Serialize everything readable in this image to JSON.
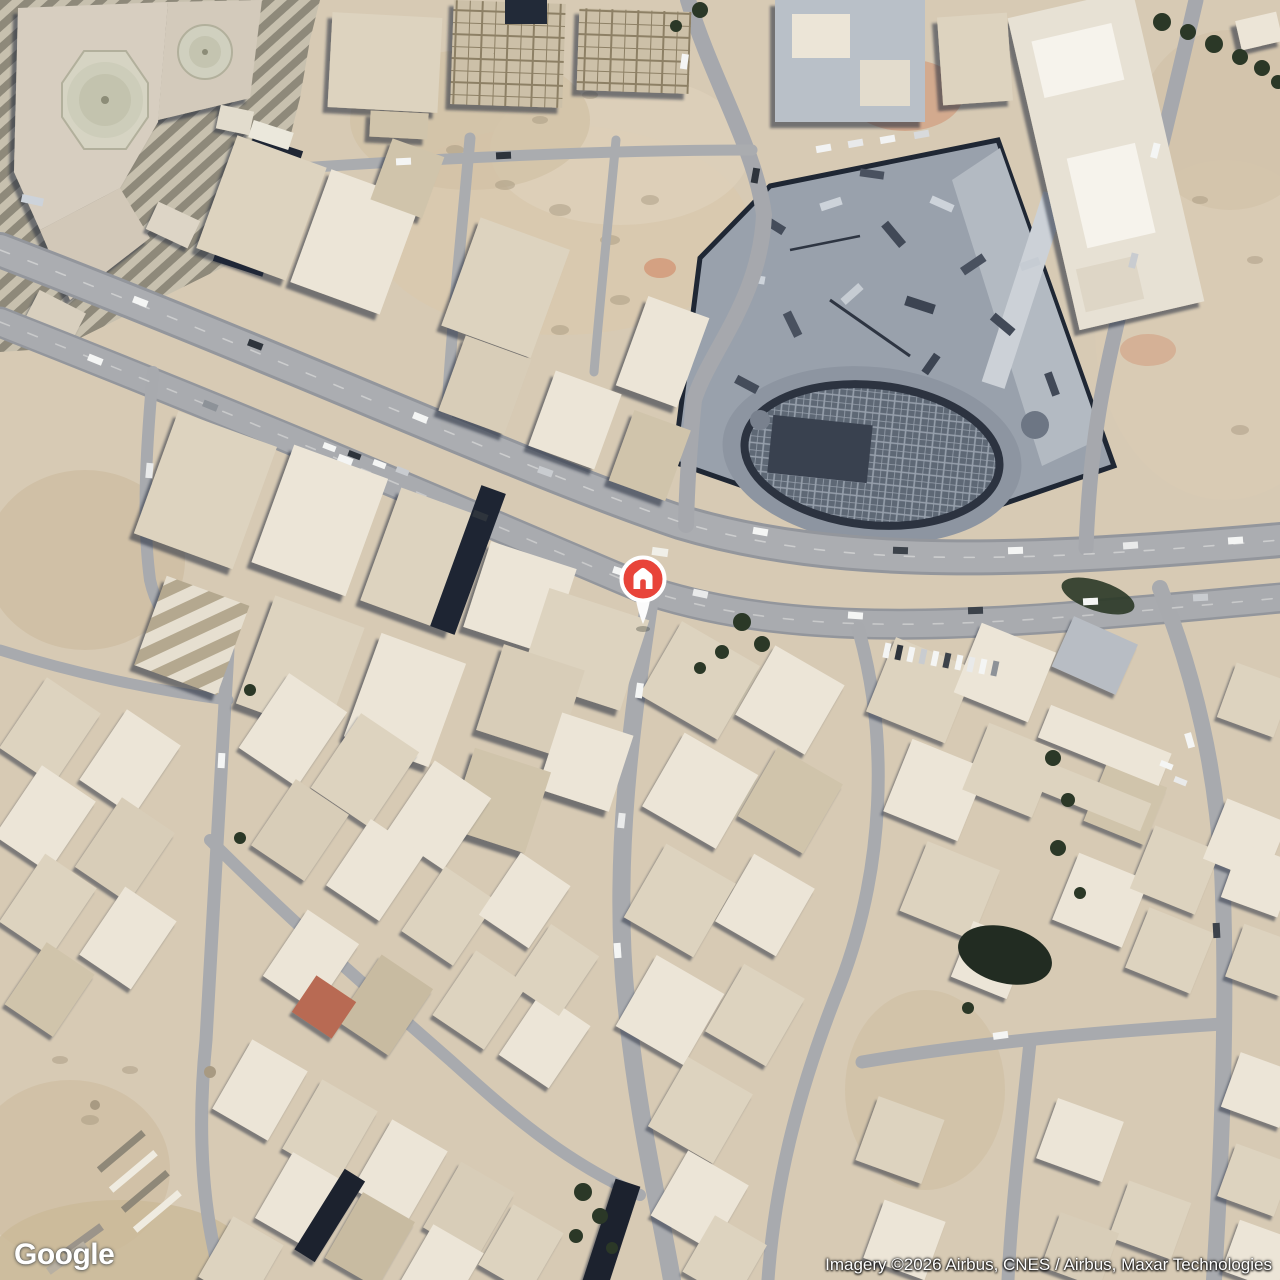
{
  "map": {
    "view_type": "satellite",
    "provider": "Google",
    "marker": {
      "type": "place-marker",
      "glyph": "home",
      "pin_color": "#E8443A",
      "glyph_color": "#FFFFFF",
      "border_color": "#FFFFFF"
    }
  },
  "watermark": {
    "logo_text": "Google"
  },
  "attribution": {
    "text": "Imagery ©2026 Airbus, CNES / Airbus, Maxar Technologies"
  },
  "palette": {
    "sand": "#d7cab4",
    "sand_dark": "#c8b598",
    "road": "#a9abb0",
    "building_light": "#ece5d7",
    "building_mid": "#ddd3bf",
    "building_tan": "#d0c4ab",
    "shadow_navy": "#1f2634",
    "construction_grey": "#99a1ac",
    "construction_dark": "#39414f",
    "tree_green": "#2b3827",
    "pin_red": "#E8443A"
  }
}
